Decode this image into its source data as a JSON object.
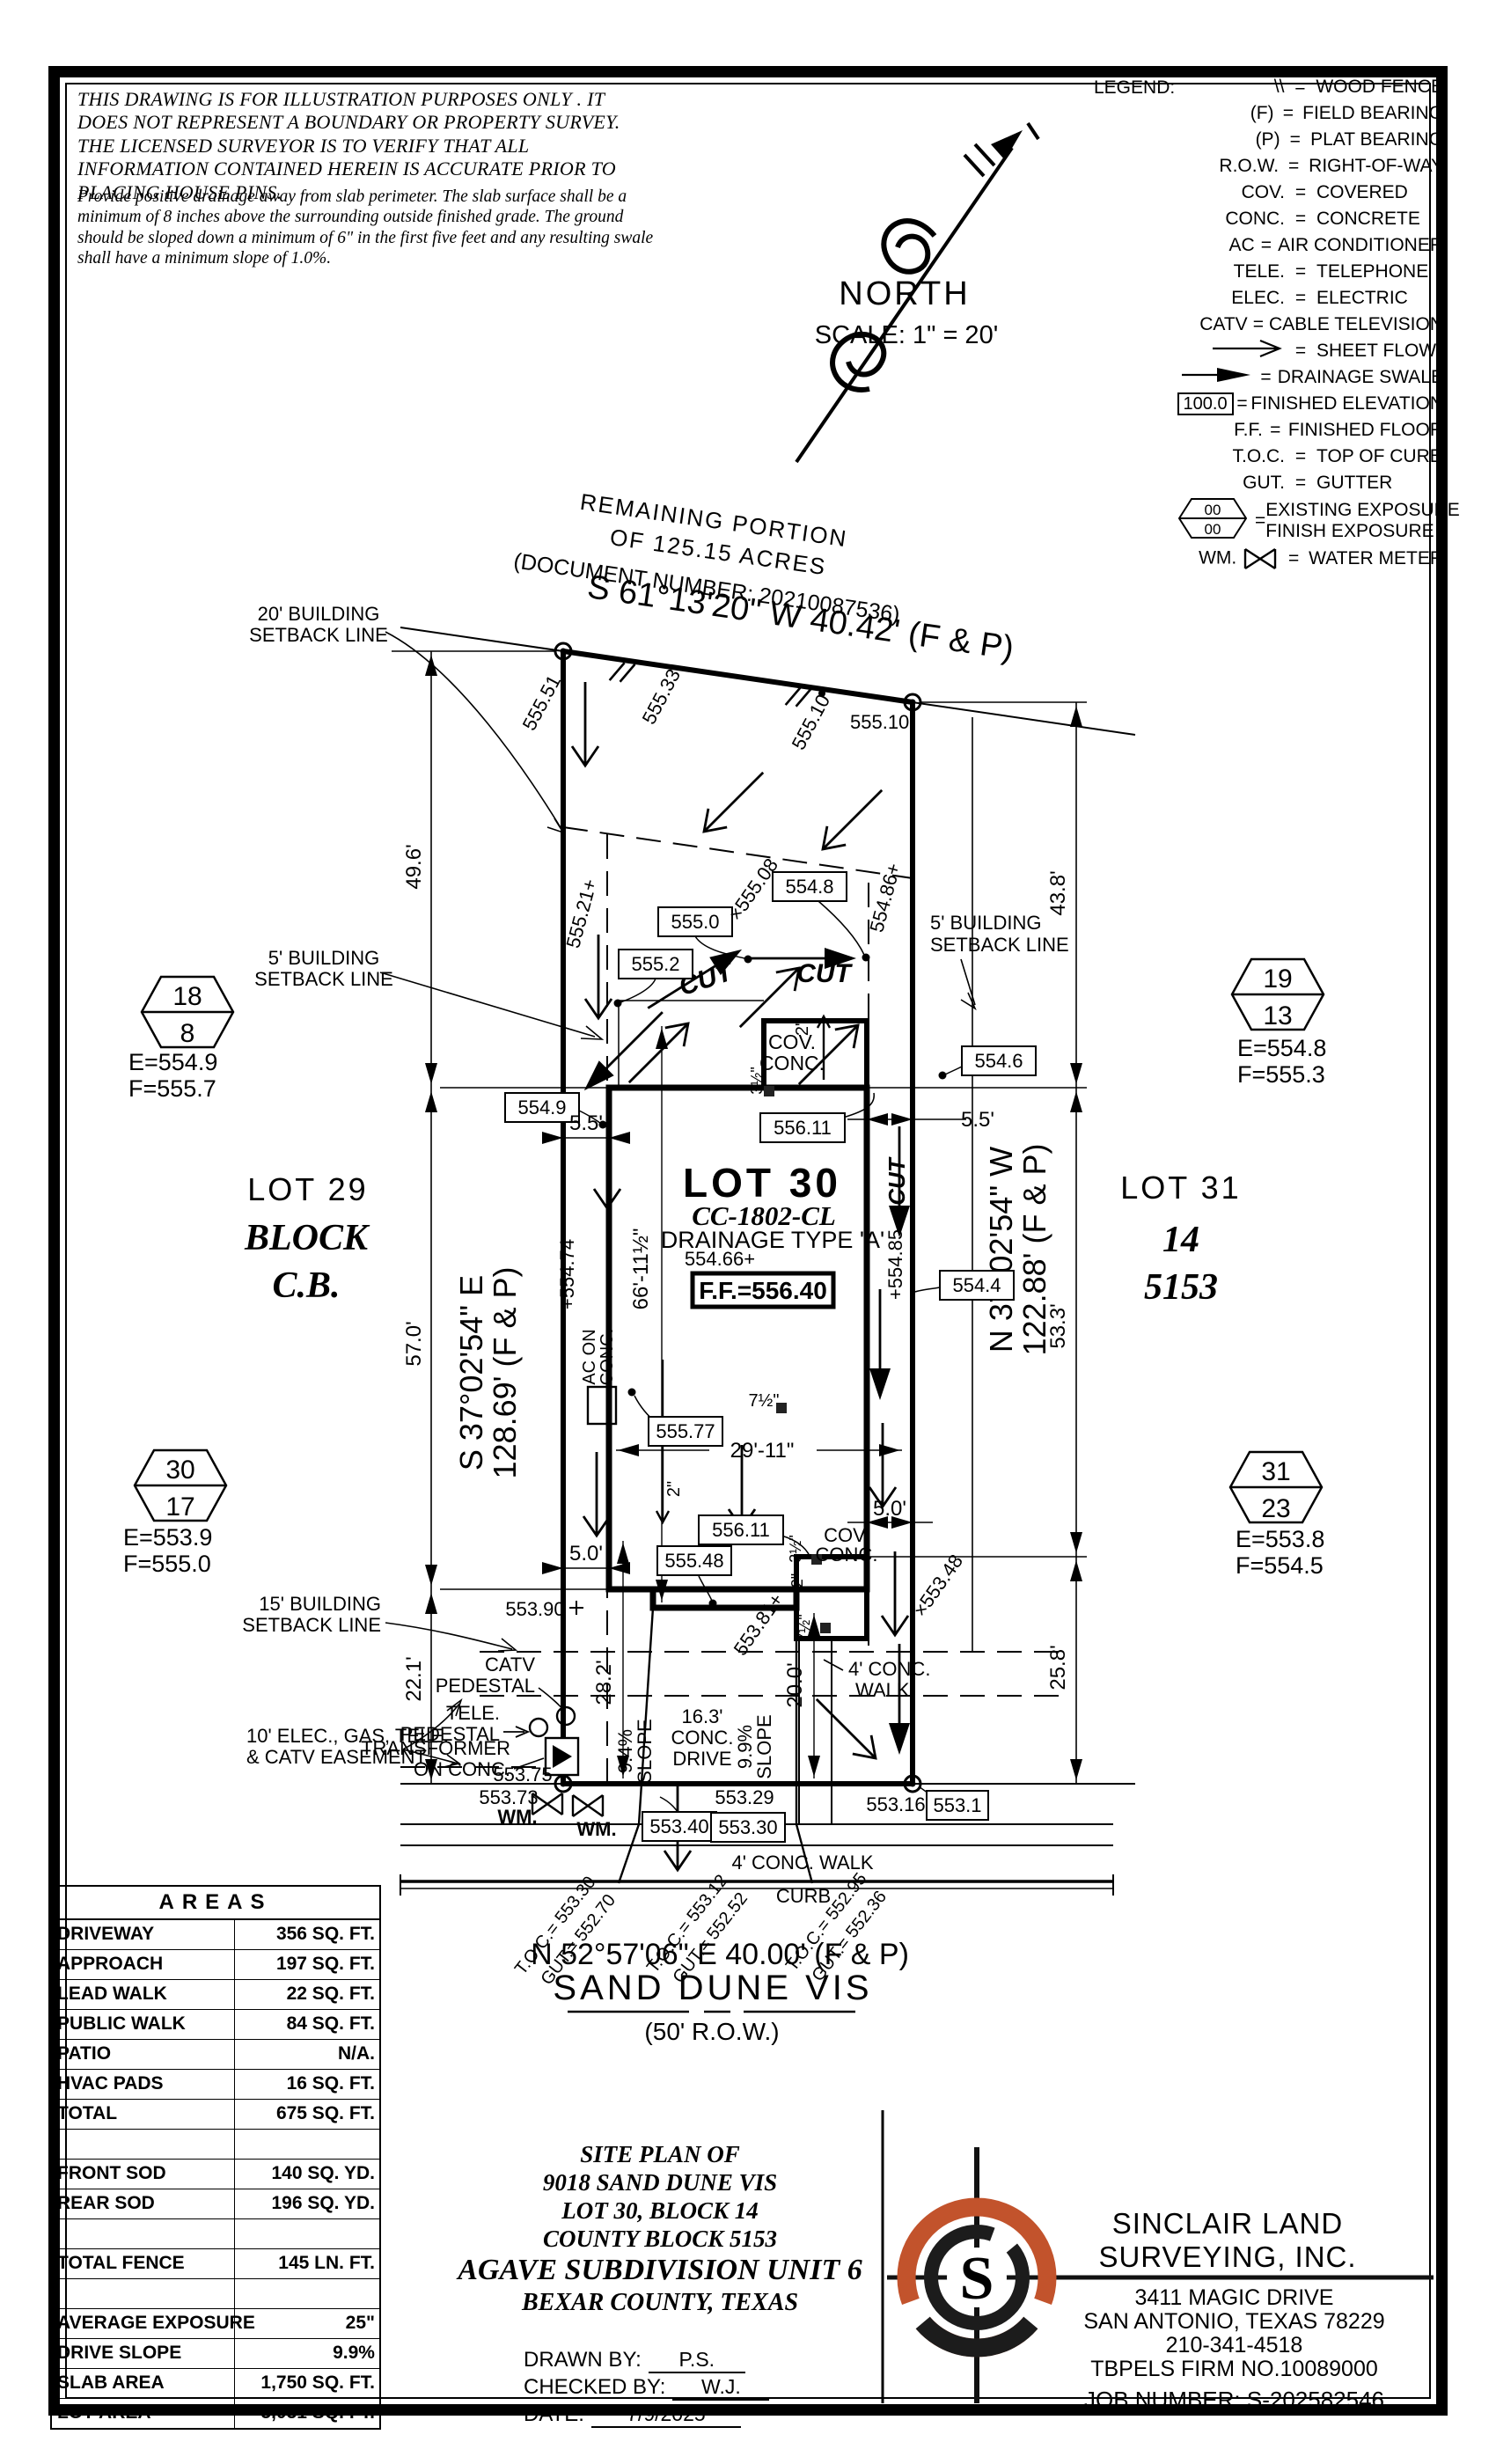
{
  "disclaimer": {
    "warning": "THIS DRAWING IS FOR ILLUSTRATION PURPOSES ONLY . IT DOES NOT REPRESENT A BOUNDARY OR PROPERTY SURVEY. THE LICENSED SURVEYOR IS TO VERIFY THAT ALL INFORMATION CONTAINED HEREIN IS ACCURATE PRIOR TO PLACING HOUSE PINS.",
    "note": "Provide positive drainage away from slab perimeter. The slab surface shall be a minimum of 8 inches above the surrounding outside finished grade. The ground should be sloped down a minimum of 6\" in the first five feet and any resulting swale shall have a minimum slope of 1.0%."
  },
  "north": {
    "label": "NORTH",
    "scale": "SCALE: 1\" = 20'"
  },
  "legend": {
    "title": "LEGEND:",
    "eq": "=",
    "items": [
      {
        "sym": "\\\\",
        "desc": "WOOD FENCE"
      },
      {
        "sym": "(F)",
        "desc": "FIELD BEARING"
      },
      {
        "sym": "(P)",
        "desc": "PLAT BEARING"
      },
      {
        "sym": "R.O.W.",
        "desc": "RIGHT-OF-WAY"
      },
      {
        "sym": "COV.",
        "desc": "COVERED"
      },
      {
        "sym": "CONC.",
        "desc": "CONCRETE"
      },
      {
        "sym": "AC",
        "desc": "AIR CONDITIONER"
      },
      {
        "sym": "TELE.",
        "desc": "TELEPHONE"
      },
      {
        "sym": "ELEC.",
        "desc": "ELECTRIC"
      },
      {
        "sym": "CATV",
        "desc": "CABLE TELEVISION"
      },
      {
        "sym": "",
        "desc": "SHEET FLOW"
      },
      {
        "sym": "",
        "desc": "DRAINAGE SWALE"
      },
      {
        "sym": "100.0",
        "desc": "FINISHED ELEVATION"
      },
      {
        "sym": "F.F.",
        "desc": "FINISHED FLOOR"
      },
      {
        "sym": "T.O.C.",
        "desc": "TOP OF CURB"
      },
      {
        "sym": "GUT.",
        "desc": "GUTTER"
      },
      {
        "num": "00",
        "den": "00",
        "desc": "EXISTING EXPOSURE",
        "desc2": "FINISH EXPOSURE"
      },
      {
        "sym": "WM.",
        "desc": "WATER METER"
      }
    ]
  },
  "plan": {
    "remaining": [
      "REMAINING PORTION",
      "OF 125.15 ACRES",
      "(DOCUMENT NUMBER: 20210087536)"
    ],
    "bearings": {
      "rear": "S 61°13'20\" W 40.42' (F & P)",
      "left1": "S 37°02'54\" E",
      "left2": "128.69' (F & P)",
      "right1": "N 37°02'54\" W",
      "right2": "122.88' (F & P)",
      "front": "N 52°57'06\" E 40.00' (F & P)"
    },
    "street": {
      "name": "SAND DUNE VIS",
      "row": "(50' R.O.W.)",
      "curb": "CURB",
      "walk": "4' CONC. WALK"
    },
    "lot30": {
      "name": "LOT 30",
      "plan_code": "CC-1802-CL",
      "drainage": "DRAINAGE TYPE 'A'",
      "ff": "F.F.=556.40",
      "ff_spot": "554.66+"
    },
    "lot29": {
      "name": "LOT 29",
      "block1": "BLOCK",
      "block2": "C.B."
    },
    "lot31": {
      "name": "LOT 31",
      "block": "14",
      "cb": "5153"
    },
    "hex": [
      {
        "n": "18",
        "d": "8",
        "e": "E=554.9",
        "f": "F=555.7"
      },
      {
        "n": "19",
        "d": "13",
        "e": "E=554.8",
        "f": "F=555.3"
      },
      {
        "n": "30",
        "d": "17",
        "e": "E=553.9",
        "f": "F=555.0"
      },
      {
        "n": "31",
        "d": "23",
        "e": "E=553.8",
        "f": "F=554.5"
      }
    ],
    "labels": {
      "setback20a": "20' BUILDING",
      "setback20b": "SETBACK LINE",
      "setback5a": "5' BUILDING",
      "setback5b": "SETBACK LINE",
      "setback15a": "15' BUILDING",
      "setback15b": "SETBACK LINE",
      "easement1": "10' ELEC., GAS, TELE.",
      "easement2": "& CATV EASEMENT",
      "catv1": "CATV",
      "catv2": "PEDESTAL",
      "tele1": "TELE.",
      "tele2": "PEDESTAL",
      "xfmr1": "TRANSFORMER",
      "xfmr2": "ON CONC.",
      "cov1": "COV.",
      "cov2": "CONC.",
      "ac1": "AC ON",
      "ac2": "CONC.",
      "cut": "CUT",
      "wm": "WM.",
      "drive1": "16.3'",
      "drive2": "CONC.",
      "drive3": "DRIVE",
      "slope94a": "9.4%",
      "slope94b": "SLOPE",
      "slope99a": "9.9%",
      "slope99b": "SLOPE",
      "walk1": "4' CONC.",
      "walk2": "WALK"
    },
    "dims": {
      "d496": "49.6'",
      "d438": "43.8'",
      "d570": "57.0'",
      "d533": "53.3'",
      "d258": "25.8'",
      "d221": "22.1'",
      "d282": "28.2'",
      "d200": "20.0'",
      "d55": "5.5'",
      "d50": "5.0'",
      "d6611": "66'-11½\"",
      "d2911": "29'-11\"",
      "d2": "2\"",
      "d35": "3½\"",
      "d75": "7½\""
    },
    "elev_boxed": {
      "e5550": "555.0",
      "e5552": "555.2",
      "e5548": "554.8",
      "e5549": "554.9",
      "e5546": "554.6",
      "e5544": "554.4",
      "e55611": "556.11",
      "e55577": "555.77",
      "e55548": "555.48",
      "e55340": "553.40",
      "e55330": "553.30",
      "e5531": "553.1"
    },
    "elev_spot": {
      "s55551": "555.51",
      "s55533": "555.33",
      "s55510": "555.10",
      "s55521": "555.21+",
      "s55508": "×555.08",
      "s55486": "554.86+",
      "s55474": "+554.74",
      "s55485": "+554.85",
      "s55390": "553.90",
      "s55375": "553.75",
      "s55373": "553.73",
      "s55329": "553.29",
      "s55316": "553.16",
      "s55348": "×553.48",
      "s55381": "553.81+"
    },
    "toc": [
      {
        "t": "T.O.C.= 553.30",
        "g": "GUT.= 552.70"
      },
      {
        "t": "T.O.C.= 553.12",
        "g": "GUT.= 552.52"
      },
      {
        "t": "T.O.C.= 552.95",
        "g": "GUT.= 552.36"
      }
    ]
  },
  "areas": {
    "title": "AREAS",
    "rows": [
      {
        "label": "DRIVEWAY",
        "value": "356 SQ. FT."
      },
      {
        "label": "APPROACH",
        "value": "197 SQ. FT."
      },
      {
        "label": "LEAD WALK",
        "value": "22 SQ. FT."
      },
      {
        "label": "PUBLIC WALK",
        "value": "84 SQ. FT."
      },
      {
        "label": "PATIO",
        "value": "N/A."
      },
      {
        "label": "HVAC PADS",
        "value": "16 SQ. FT."
      },
      {
        "label": "TOTAL",
        "value": "675 SQ. FT."
      },
      {
        "label": "",
        "value": ""
      },
      {
        "label": "FRONT SOD",
        "value": "140 SQ. YD."
      },
      {
        "label": "REAR SOD",
        "value": "196 SQ. YD."
      },
      {
        "label": "",
        "value": ""
      },
      {
        "label": "TOTAL FENCE",
        "value": "145 LN. FT."
      },
      {
        "label": "",
        "value": ""
      },
      {
        "label": "AVERAGE EXPOSURE",
        "value": "25\""
      },
      {
        "label": "DRIVE SLOPE",
        "value": "9.9%"
      },
      {
        "label": "SLAB AREA",
        "value": "1,750 SQ. FT."
      },
      {
        "label": "LOT AREA",
        "value": "5,031 SQ. FT."
      }
    ]
  },
  "title_block": {
    "line1": "SITE PLAN OF",
    "line2": "9018 SAND DUNE VIS",
    "line3": "LOT 30, BLOCK 14",
    "line4": "COUNTY BLOCK 5153",
    "line5": "AGAVE SUBDIVISION UNIT 6",
    "line6": "BEXAR COUNTY, TEXAS",
    "drawn_label": "DRAWN BY:",
    "drawn": "P.S.",
    "checked_label": "CHECKED BY:",
    "checked": "W.J.",
    "date_label": "DATE:",
    "date": "7/9/2025"
  },
  "company": {
    "name1": "SINCLAIR LAND",
    "name2": "SURVEYING, INC.",
    "addr1": "3411 MAGIC DRIVE",
    "addr2": "SAN ANTONIO, TEXAS 78229",
    "phone": "210-341-4518",
    "firm": "TBPELS FIRM NO.10089000",
    "job": "JOB NUMBER: S-202582546",
    "logo_letter": "S"
  },
  "colors": {
    "accent": "#c2532c",
    "ink": "#000000"
  }
}
